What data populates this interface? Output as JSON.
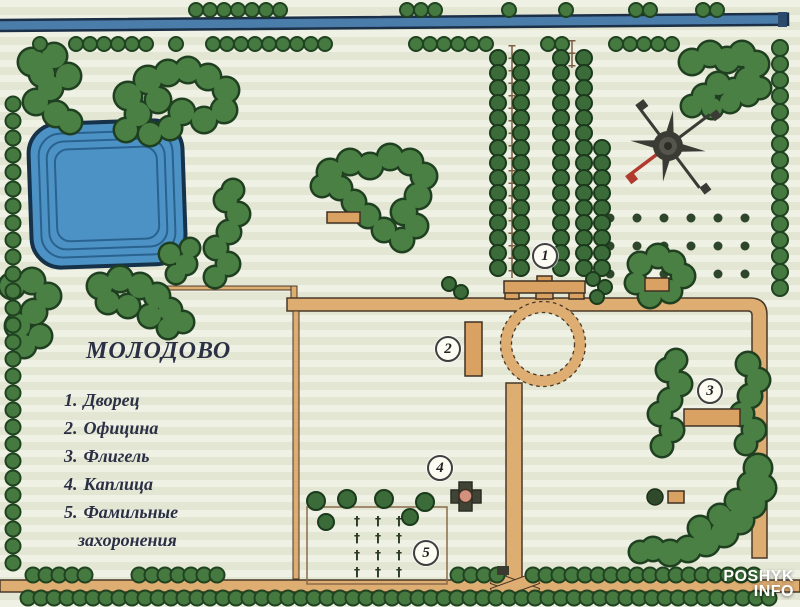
{
  "map": {
    "title": "МОЛОДОВО",
    "legend": {
      "items": [
        {
          "num": "1.",
          "label": "Дворец"
        },
        {
          "num": "2.",
          "label": "Официна"
        },
        {
          "num": "3.",
          "label": "Флигель"
        },
        {
          "num": "4.",
          "label": "Каплица"
        },
        {
          "num": "5.",
          "label": "Фамильные"
        }
      ],
      "item5_cont": "захоронения"
    },
    "markers": [
      {
        "num": "1",
        "label": "Дворец"
      },
      {
        "num": "2",
        "label": "Официна"
      },
      {
        "num": "3",
        "label": "Флигель"
      },
      {
        "num": "4",
        "label": "Каплица"
      },
      {
        "num": "5",
        "label": "Фамильные захоронения"
      }
    ],
    "watermark": {
      "line1": "POSHYK",
      "line2": "INFO"
    },
    "colors": {
      "background": "#e9ecda",
      "water_pond": "#4d92c5",
      "water_river": "#4b7dab",
      "trees": "#4b8044",
      "roads": "#ddad72",
      "buildings": "#d9a263",
      "compass_red": "#b03a2e"
    }
  }
}
